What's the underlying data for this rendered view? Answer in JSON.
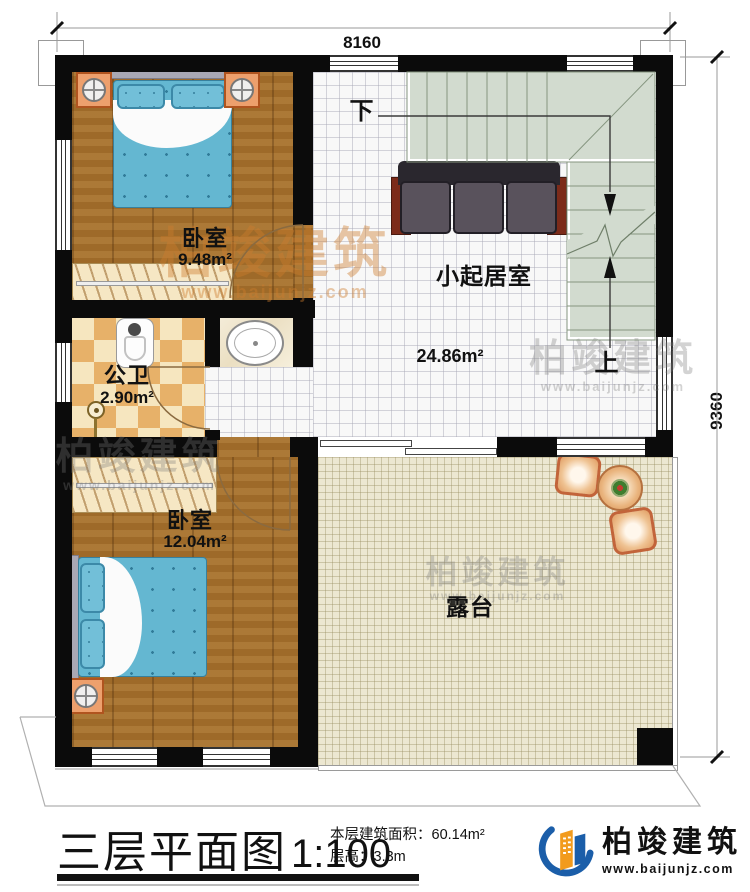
{
  "dimensions": {
    "top": "8160",
    "right": "9360"
  },
  "rooms": {
    "bedroom1": {
      "name": "卧室",
      "area": "9.48m²"
    },
    "living": {
      "name": "小起居室",
      "area": "24.86m²"
    },
    "bathroom": {
      "name": "公卫",
      "area": "2.90m²"
    },
    "bedroom2": {
      "name": "卧室",
      "area": "12.04m²"
    },
    "terrace": {
      "name": "露台"
    }
  },
  "stairs": {
    "up_label": "上",
    "down_label": "下"
  },
  "title_block": {
    "title": "三层平面图",
    "scale": "1:100",
    "area_label": "本层建筑面积：",
    "area_value": "60.14m²",
    "height_label": "层高：",
    "height_value": "3.3m"
  },
  "brand": {
    "name": "柏竣建筑",
    "url": "www.baijunjz.com"
  },
  "watermark": {
    "brand": "柏竣建筑",
    "url": "www.baijunjz.com",
    "url_short": "baijunjz.com"
  },
  "colors": {
    "wall": "#0b0b0b",
    "wood": "#a5702c",
    "tile": "#f8f8f8",
    "stair": "#d2dbcf",
    "checker": "#e7b169",
    "terrace": "#ece7d1",
    "bed_blanket": "#64b7d1",
    "sofa": "#59525c",
    "brand_blue": "#1b5ea9",
    "brand_orange": "#f29b1d"
  }
}
